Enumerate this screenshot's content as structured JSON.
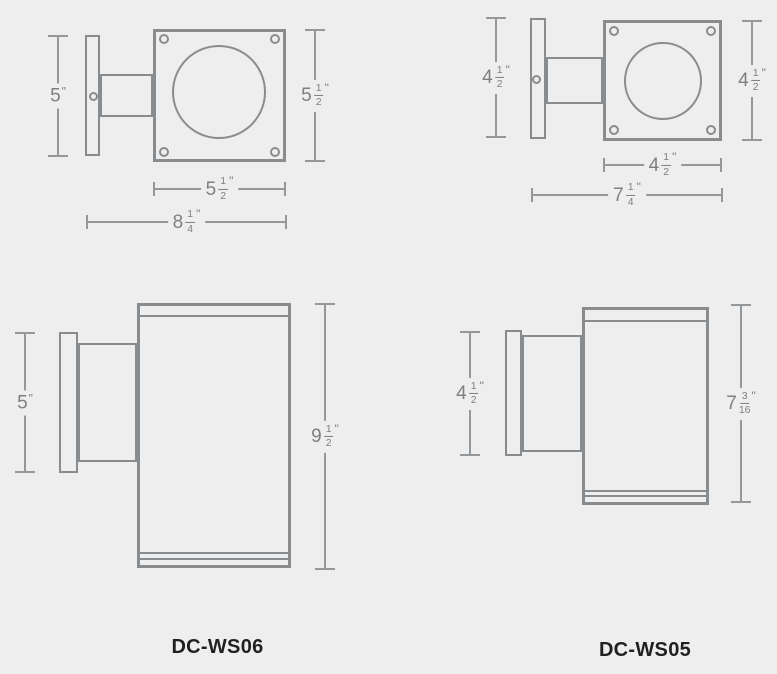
{
  "page": {
    "background": "#eeeeee",
    "type": "dimensional-line-drawing"
  },
  "colors": {
    "fixture_line": "#898c8e",
    "dimension_line": "#95989a",
    "dimension_text": "#7d8082",
    "label_text": "#1f2022"
  },
  "drawings": {
    "ws06_top": {
      "dims": {
        "backplate_height": {
          "whole": "5",
          "unit": "\""
        },
        "faceplate_height": {
          "whole": "5",
          "num": "1",
          "den": "2",
          "unit": "\""
        },
        "faceplate_width": {
          "whole": "5",
          "num": "1",
          "den": "2",
          "unit": "\""
        },
        "overall_depth": {
          "whole": "8",
          "num": "1",
          "den": "4",
          "unit": "\""
        }
      }
    },
    "ws05_top": {
      "dims": {
        "backplate_height": {
          "whole": "4",
          "num": "1",
          "den": "2",
          "unit": "\""
        },
        "faceplate_height": {
          "whole": "4",
          "num": "1",
          "den": "2",
          "unit": "\""
        },
        "faceplate_width": {
          "whole": "4",
          "num": "1",
          "den": "2",
          "unit": "\""
        },
        "overall_depth": {
          "whole": "7",
          "num": "1",
          "den": "4",
          "unit": "\""
        }
      }
    },
    "ws06_side": {
      "label": "DC-WS06",
      "dims": {
        "backplate_height": {
          "whole": "5",
          "unit": "\""
        },
        "overall_height": {
          "whole": "9",
          "num": "1",
          "den": "2",
          "unit": "\""
        }
      }
    },
    "ws05_side": {
      "label": "DC-WS05",
      "dims": {
        "backplate_height": {
          "whole": "4",
          "num": "1",
          "den": "2",
          "unit": "\""
        },
        "overall_height": {
          "whole": "7",
          "num": "3",
          "den": "16",
          "unit": "\""
        }
      }
    }
  }
}
